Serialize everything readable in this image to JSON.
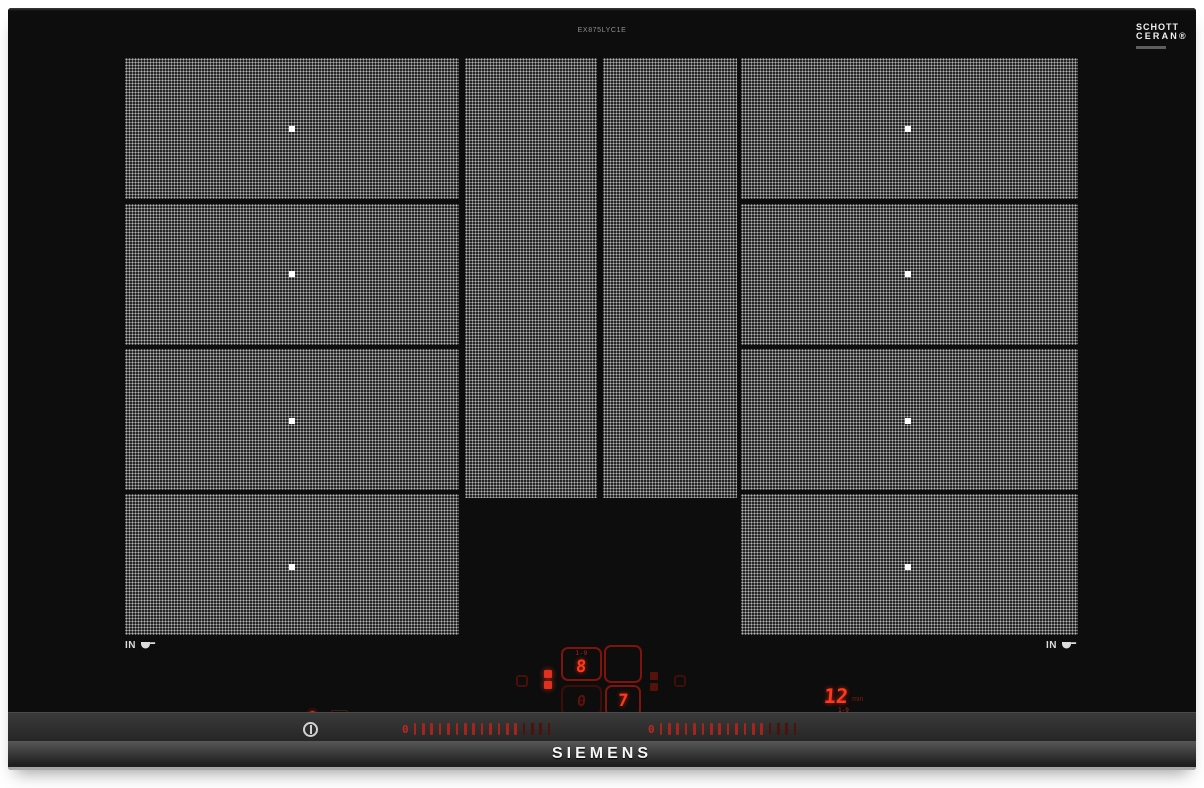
{
  "product": {
    "model": "EX875LYC1E",
    "brand": "SIEMENS",
    "glass_brand_line1": "SCHOTT",
    "glass_brand_line2": "CERAN®"
  },
  "markings": {
    "left_in": "IN",
    "right_in": "IN"
  },
  "controls": {
    "left_display": {
      "range_label": "1-9",
      "level": "8",
      "secondary_level": "0"
    },
    "right_display": {
      "level": "7"
    },
    "timer": {
      "value": "12",
      "unit": "min",
      "range_label": "1-9"
    },
    "sliders": [
      {
        "id": "left-power-slider",
        "zero": "0",
        "bright": 13,
        "dim": 4
      },
      {
        "id": "right-power-slider",
        "zero": "0",
        "bright": 13,
        "dim": 4
      }
    ]
  },
  "icons": {
    "pan_detection": "pan-with-handle",
    "power": "power-circle-with-bar",
    "flex_zone": "two-stacked-squares",
    "keep_warm": "square-outline",
    "power_led": "red-dot"
  },
  "colors": {
    "display_red": "#ff3a1c",
    "outline_red": "#7e140c",
    "dim_red": "#5f120b",
    "tick_red": "#a8241a",
    "glass_black": "#0d0d0d",
    "zone_grey": "#4f4f4f",
    "print_white": "#e8e8e8"
  }
}
